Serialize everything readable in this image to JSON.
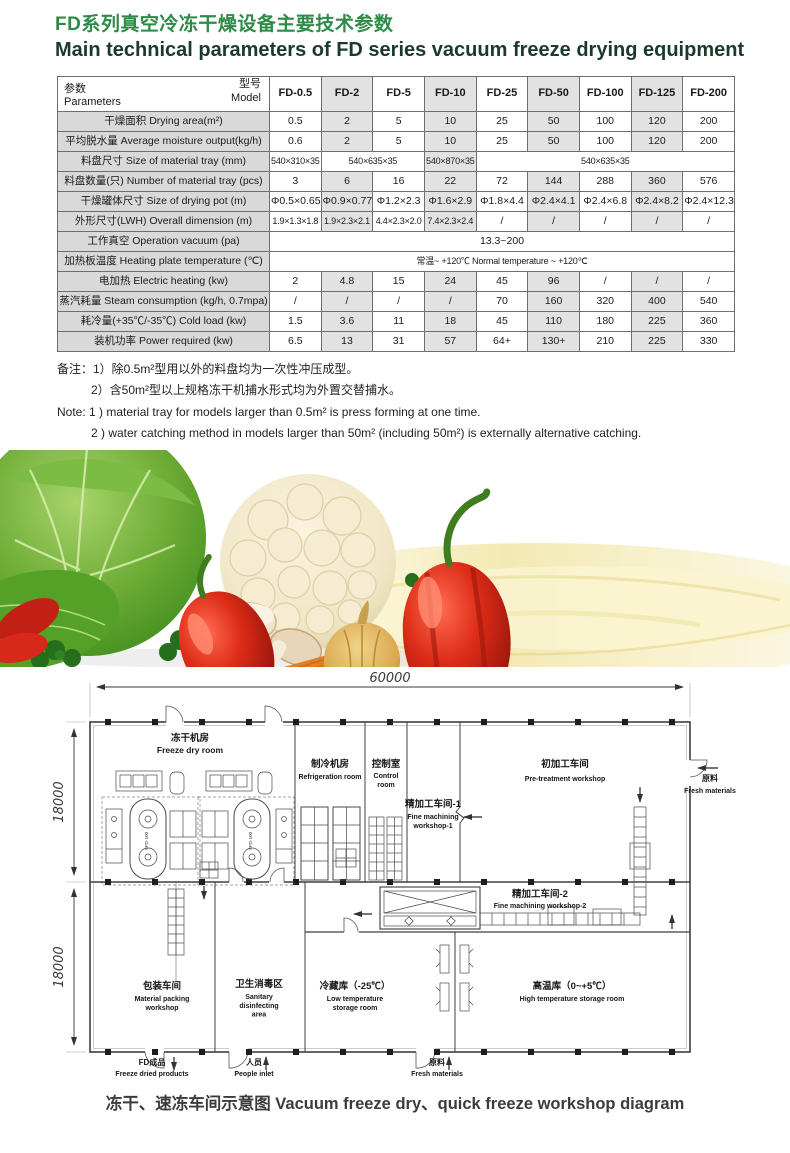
{
  "header": {
    "title_zh": "FD系列真空冷冻干燥设备主要技术参数",
    "title_en": "Main technical parameters of FD series vacuum freeze drying equipment"
  },
  "table": {
    "corner": {
      "model_zh": "型号",
      "model_en": "Model",
      "param_zh": "参数",
      "param_en": "Parameters"
    },
    "models": [
      "FD-0.5",
      "FD-2",
      "FD-5",
      "FD-10",
      "FD-25",
      "FD-50",
      "FD-100",
      "FD-125",
      "FD-200"
    ],
    "rows": [
      {
        "label": "干燥面积 Drying area(m²)",
        "cells": [
          {
            "t": "0.5"
          },
          {
            "t": "2"
          },
          {
            "t": "5"
          },
          {
            "t": "10"
          },
          {
            "t": "25"
          },
          {
            "t": "50"
          },
          {
            "t": "100"
          },
          {
            "t": "120"
          },
          {
            "t": "200"
          }
        ]
      },
      {
        "label": "平均脱水量 Average moisture output(kg/h)",
        "cells": [
          {
            "t": "0.6"
          },
          {
            "t": "2"
          },
          {
            "t": "5"
          },
          {
            "t": "10"
          },
          {
            "t": "25"
          },
          {
            "t": "50"
          },
          {
            "t": "100"
          },
          {
            "t": "120"
          },
          {
            "t": "200"
          }
        ]
      },
      {
        "label": "料盘尺寸 Size of material tray (mm)",
        "cells": [
          {
            "t": "540×310×35"
          },
          {
            "t": "540×635×35",
            "span": 2
          },
          {
            "t": "540×870×35"
          },
          {
            "t": "540×635×35",
            "span": 5
          }
        ]
      },
      {
        "label": "料盘数量(只) Number of material tray (pcs)",
        "cells": [
          {
            "t": "3"
          },
          {
            "t": "6"
          },
          {
            "t": "16"
          },
          {
            "t": "22"
          },
          {
            "t": "72"
          },
          {
            "t": "144"
          },
          {
            "t": "288"
          },
          {
            "t": "360"
          },
          {
            "t": "576"
          }
        ]
      },
      {
        "label": "干燥罐体尺寸 Size of drying pot (m)",
        "cells": [
          {
            "t": "Φ0.5×0.65"
          },
          {
            "t": "Φ0.9×0.77"
          },
          {
            "t": "Φ1.2×2.3"
          },
          {
            "t": "Φ1.6×2.9"
          },
          {
            "t": "Φ1.8×4.4"
          },
          {
            "t": "Φ2.4×4.1"
          },
          {
            "t": "Φ2.4×6.8"
          },
          {
            "t": "Φ2.4×8.2"
          },
          {
            "t": "Φ2.4×12.3"
          }
        ]
      },
      {
        "label": "外形尺寸(LWH) Overall dimension (m)",
        "cells": [
          {
            "t": "1.9×1.3×1.8"
          },
          {
            "t": "1.9×2.3×2.1"
          },
          {
            "t": "4.4×2.3×2.0"
          },
          {
            "t": "7.4×2.3×2.4"
          },
          {
            "t": "/"
          },
          {
            "t": "/"
          },
          {
            "t": "/"
          },
          {
            "t": "/"
          },
          {
            "t": "/"
          }
        ]
      },
      {
        "label": "工作真空 Operation vacuum (pa)",
        "cells": [
          {
            "t": "13.3~200",
            "span": 9
          }
        ]
      },
      {
        "label": "加热板温度 Heating plate temperature (℃)",
        "cells": [
          {
            "t": "常温~ +120℃ Normal temperature ~ +120℃",
            "span": 9
          }
        ]
      },
      {
        "label": "电加热 Electric heating (kw)",
        "cells": [
          {
            "t": "2"
          },
          {
            "t": "4.8"
          },
          {
            "t": "15"
          },
          {
            "t": "24"
          },
          {
            "t": "45"
          },
          {
            "t": "96"
          },
          {
            "t": "/"
          },
          {
            "t": "/"
          },
          {
            "t": "/"
          }
        ]
      },
      {
        "label": "蒸汽耗量 Steam consumption (kg/h, 0.7mpa)",
        "cells": [
          {
            "t": "/"
          },
          {
            "t": "/"
          },
          {
            "t": "/"
          },
          {
            "t": "/"
          },
          {
            "t": "70"
          },
          {
            "t": "160"
          },
          {
            "t": "320"
          },
          {
            "t": "400"
          },
          {
            "t": "540"
          }
        ]
      },
      {
        "label": "耗冷量(+35℃/-35℃) Cold load (kw)",
        "cells": [
          {
            "t": "1.5"
          },
          {
            "t": "3.6"
          },
          {
            "t": "11"
          },
          {
            "t": "18"
          },
          {
            "t": "45"
          },
          {
            "t": "110"
          },
          {
            "t": "180"
          },
          {
            "t": "225"
          },
          {
            "t": "360"
          }
        ]
      },
      {
        "label": "装机功率 Power required (kw)",
        "cells": [
          {
            "t": "6.5"
          },
          {
            "t": "13"
          },
          {
            "t": "31"
          },
          {
            "t": "57"
          },
          {
            "t": "64+"
          },
          {
            "t": "130+"
          },
          {
            "t": "210"
          },
          {
            "t": "225"
          },
          {
            "t": "330"
          }
        ]
      }
    ]
  },
  "notes": {
    "zh1": "备注：1）除0.5m²型用以外的料盘均为一次性冲压成型。",
    "zh2": "2）含50m²型以上规格冻干机捕水形式均为外置交替捕水。",
    "en1": "Note: 1 ) material tray for models larger than 0.5m² is press forming at one time.",
    "en2": "2 ) water catching method in models larger than 50m² (including 50m²) is externally alternative catching."
  },
  "banner": {
    "description": "Photo of fresh vegetables: savoy cabbage, cauliflower, red bell peppers, mushrooms, onion, carrot and parsley against a pale yellow swirl background"
  },
  "floorplan": {
    "dim_width": "60000",
    "dim_height_top": "18000",
    "dim_height_bottom": "18000",
    "equipment_label": "SPD-100",
    "rooms": {
      "freeze_dry": {
        "zh": "冻干机房",
        "en": "Freeze dry room"
      },
      "refrigeration": {
        "zh": "制冷机房",
        "en": "Refrigeration room"
      },
      "control": {
        "zh": "控制室",
        "en": "Control\nroom"
      },
      "fine1": {
        "zh": "精加工车间-1",
        "en": "Fine machining\nworkshop-1"
      },
      "pretreatment": {
        "zh": "初加工车间",
        "en": "Pre-treatment workshop"
      },
      "fine2": {
        "zh": "精加工车间-2",
        "en": "Fine machining workshop-2"
      },
      "packing": {
        "zh": "包装车间",
        "en": "Material packing\nworkshop"
      },
      "sanitary": {
        "zh": "卫生消毒区",
        "en": "Sanitary\ndisinfecting\narea"
      },
      "cold_storage": {
        "zh": "冷藏库（-25℃）",
        "en": "Low temperature\nstorage room"
      },
      "warm_storage": {
        "zh": "高温库（0~+5℃）",
        "en": "High temperature storage room"
      }
    },
    "entries": {
      "fresh_in_right": {
        "zh": "原料",
        "en": "Fresh materials"
      },
      "products_out": {
        "zh": "FD成品",
        "en": "Freeze dried products"
      },
      "people_in": {
        "zh": "人员",
        "en": "People inlet"
      },
      "fresh_in_bottom": {
        "zh": "原料",
        "en": "Fresh materials"
      }
    }
  },
  "caption": {
    "text": "冻干、速冻车间示意图 Vacuum freeze dry、quick freeze workshop diagram"
  }
}
